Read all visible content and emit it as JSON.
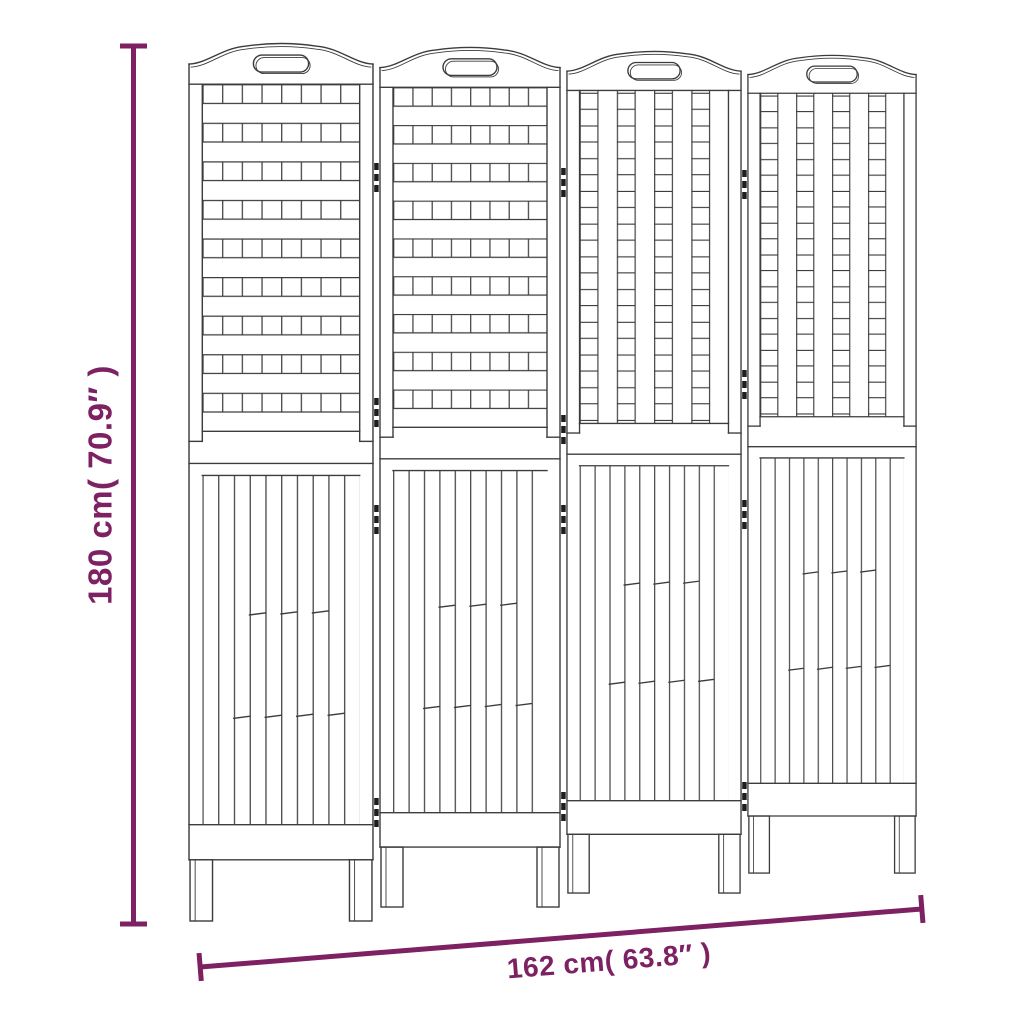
{
  "dimensions": {
    "height_label": "180 cm( 70.9″ )",
    "width_label": "162 cm( 63.8″ )"
  },
  "drawing": {
    "subject": "4-panel folding room divider screen, line drawing",
    "panel_count": 4,
    "panels": [
      {
        "id": "panel-1",
        "upper_lattice": "horizontal-grid-weave",
        "lower": "vertical-slats"
      },
      {
        "id": "panel-2",
        "upper_lattice": "horizontal-grid-weave",
        "lower": "vertical-slats"
      },
      {
        "id": "panel-3",
        "upper_lattice": "vertical-grid-weave",
        "lower": "vertical-slats"
      },
      {
        "id": "panel-4",
        "upper_lattice": "vertical-grid-weave",
        "lower": "vertical-slats"
      }
    ],
    "joints": 3,
    "hinge_mark_rows_per_joint": 4
  },
  "colors": {
    "dimension_accent": "#7D2163",
    "drawing_line": "#3c3c3c",
    "background": "#ffffff"
  }
}
